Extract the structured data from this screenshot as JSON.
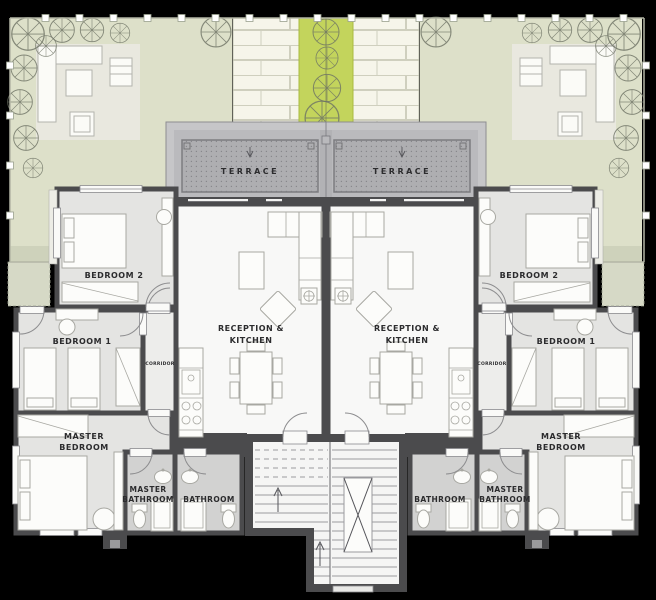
{
  "title": "Residential floor plan — two mirrored apartment units with garden and shared stairwell",
  "colors": {
    "background": "#000000",
    "garden": "#dde0c9",
    "garden_band": "#ced2bb",
    "green_strip": "#c3d45c",
    "brick_path": "#f6f5ea",
    "patio": "#e9e8df",
    "terrace_outer": "#c6c6c8",
    "terrace_inner": "#bababd",
    "terrace_deck": "#aeaeb1",
    "wall": "#4b4b4d",
    "bedroom_floor": "#e4e4e2",
    "bathroom_floor": "#d2d2d1",
    "corridor_floor": "#ededeb",
    "reception_floor": "#f8f8f7",
    "stair_floor": "#f5f5f4",
    "label_text": "#2c2c2e"
  },
  "labels": {
    "terrace": "TERRACE",
    "reception_line1": "RECEPTION &",
    "reception_line2": "KITCHEN",
    "bedroom1": "BEDROOM 1",
    "bedroom2": "BEDROOM 2",
    "master_bedroom_line1": "MASTER",
    "master_bedroom_line2": "BEDROOM",
    "master_bathroom_line1": "MASTER",
    "master_bathroom_line2": "BATHROOM",
    "bathroom": "BATHROOM",
    "corridor": "CORRIDOR"
  },
  "units": [
    "left",
    "right"
  ]
}
